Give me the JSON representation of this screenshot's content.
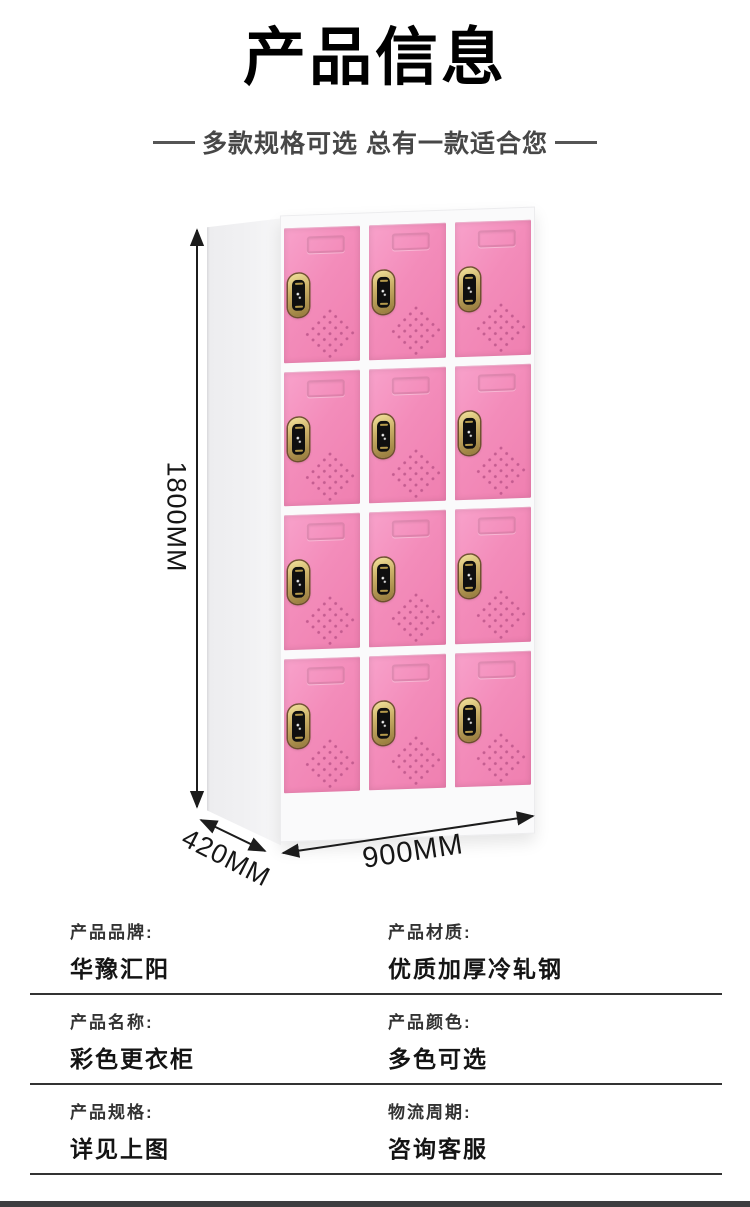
{
  "header": {
    "title": "产品信息",
    "subtitle": "多款规格可选 总有一款适合您"
  },
  "product_figure": {
    "type": "locker-cabinet-photo",
    "dimensions": {
      "height_label": "1800MM",
      "depth_label": "420MM",
      "width_label": "900MM"
    },
    "locker": {
      "rows": 4,
      "columns": 3,
      "door_color": "#f38cba",
      "body_color": "#fafafb",
      "lock_outer_color": "#cbb068",
      "lock_screen_color": "#0f0f0f",
      "vent_dot_color": "#c25a8e"
    }
  },
  "spec_table": {
    "rows": [
      {
        "left": {
          "label": "产品品牌:",
          "value": "华豫汇阳"
        },
        "right": {
          "label": "产品材质:",
          "value": "优质加厚冷轧钢"
        }
      },
      {
        "left": {
          "label": "产品名称:",
          "value": "彩色更衣柜"
        },
        "right": {
          "label": "产品颜色:",
          "value": "多色可选"
        }
      },
      {
        "left": {
          "label": "产品规格:",
          "value": "详见上图"
        },
        "right": {
          "label": "物流周期:",
          "value": "咨询客服"
        }
      }
    ]
  },
  "footer": {
    "bar_color": "#3d3d40"
  }
}
